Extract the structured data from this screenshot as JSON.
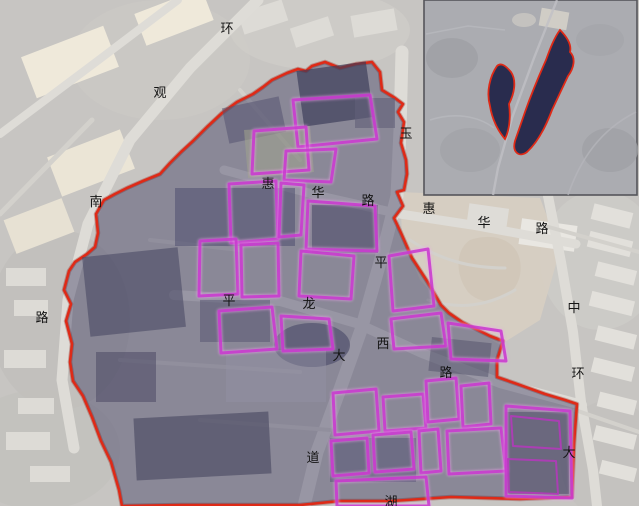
{
  "map": {
    "road_labels": [
      {
        "name": "环观南路",
        "chars": [
          {
            "ch": "环"
          },
          {
            "ch": "观"
          },
          {
            "ch": "南"
          },
          {
            "ch": "路"
          }
        ]
      },
      {
        "name": "惠华路(西段)",
        "chars": [
          {
            "ch": "惠"
          },
          {
            "ch": "华"
          },
          {
            "ch": "路"
          }
        ]
      },
      {
        "name": "惠华路(东段)",
        "chars": [
          {
            "ch": "惠"
          },
          {
            "ch": "华"
          },
          {
            "ch": "路"
          }
        ]
      },
      {
        "name": "玉平大道",
        "chars": [
          {
            "ch": "玉"
          },
          {
            "ch": "平"
          },
          {
            "ch": "大"
          },
          {
            "ch": "道"
          }
        ]
      },
      {
        "name": "平龙西路",
        "chars": [
          {
            "ch": "平"
          },
          {
            "ch": "龙"
          },
          {
            "ch": "西"
          },
          {
            "ch": "路"
          }
        ]
      },
      {
        "name": "中环大道",
        "chars": [
          {
            "ch": "中"
          },
          {
            "ch": "环"
          },
          {
            "ch": "大"
          }
        ]
      },
      {
        "name": "湖(底边截断)",
        "chars": [
          {
            "ch": "湖"
          }
        ]
      }
    ],
    "colors": {
      "boundary_line": "#de2a17",
      "parcel_line": "#cb3ed1",
      "area_tint": "#2f2e58",
      "inset_shape_fill": "#292c4e",
      "satellite_base": "#c7c5c2"
    }
  }
}
